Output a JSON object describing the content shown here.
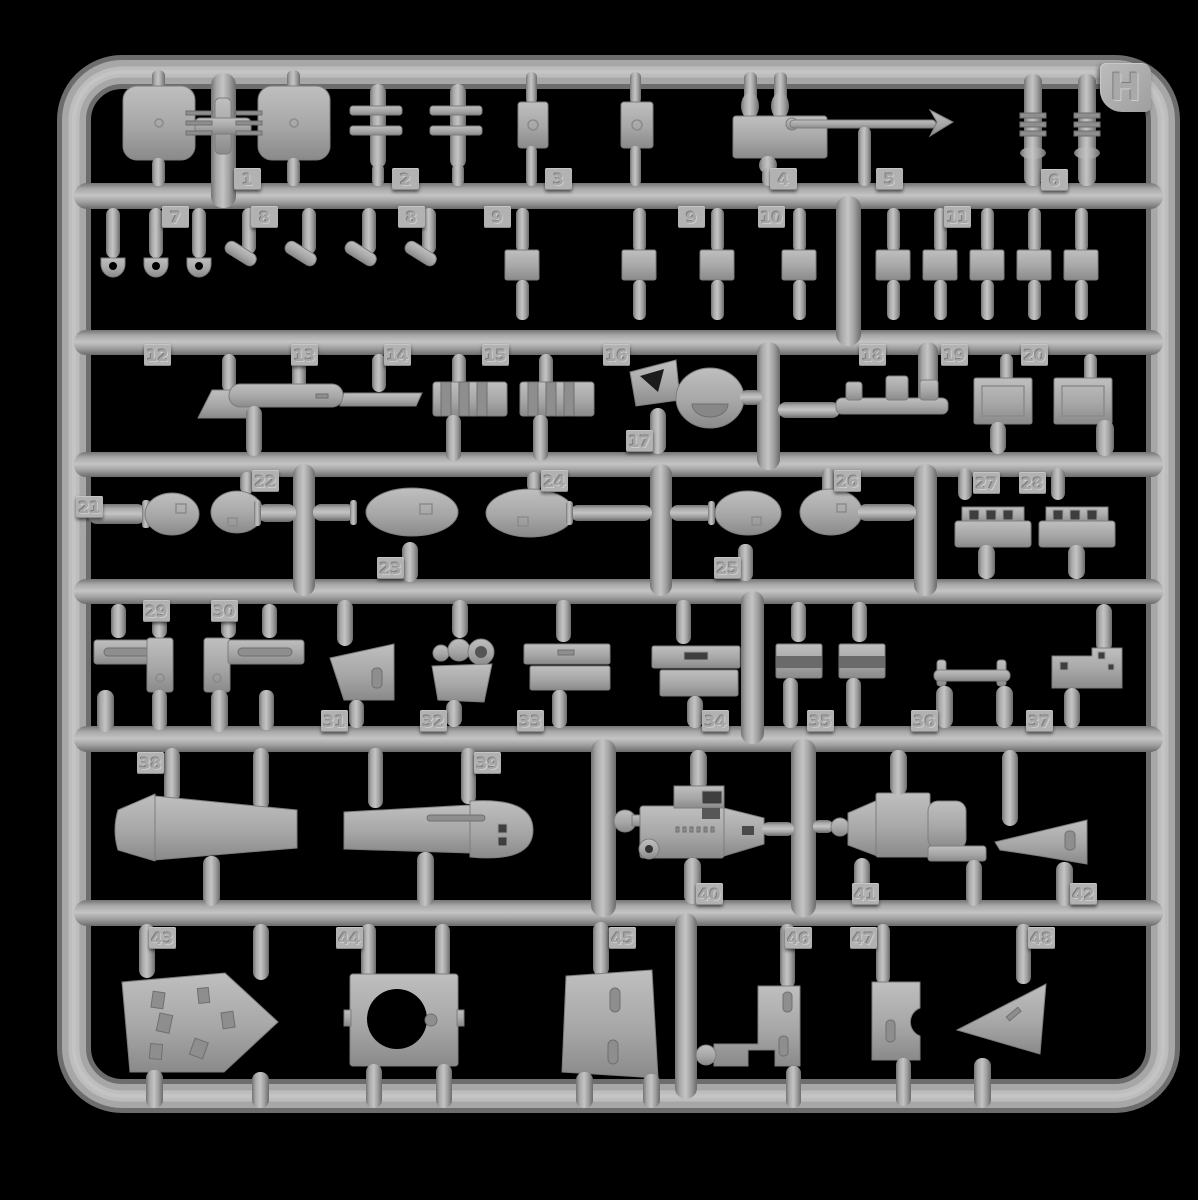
{
  "colors": {
    "background": "#000000",
    "plastic_mid": "#a9a9a9",
    "plastic_highlight": "#c4c4c4",
    "plastic_shadow": "#6e6e6e",
    "tag_plate": "#b2b2b2"
  },
  "sprue": {
    "letter": "H",
    "part_tags": [
      {
        "label": "1",
        "x": 234,
        "y": 168
      },
      {
        "label": "2",
        "x": 392,
        "y": 168
      },
      {
        "label": "3",
        "x": 545,
        "y": 168
      },
      {
        "label": "4",
        "x": 770,
        "y": 168
      },
      {
        "label": "5",
        "x": 876,
        "y": 168
      },
      {
        "label": "6",
        "x": 1041,
        "y": 169
      },
      {
        "label": "7",
        "x": 162,
        "y": 206
      },
      {
        "label": "8",
        "x": 251,
        "y": 206
      },
      {
        "label": "8",
        "x": 398,
        "y": 206
      },
      {
        "label": "9",
        "x": 484,
        "y": 206
      },
      {
        "label": "9",
        "x": 678,
        "y": 206
      },
      {
        "label": "10",
        "x": 758,
        "y": 206
      },
      {
        "label": "11",
        "x": 944,
        "y": 206
      },
      {
        "label": "12",
        "x": 144,
        "y": 344
      },
      {
        "label": "13",
        "x": 291,
        "y": 344
      },
      {
        "label": "14",
        "x": 384,
        "y": 344
      },
      {
        "label": "15",
        "x": 482,
        "y": 344
      },
      {
        "label": "16",
        "x": 603,
        "y": 344
      },
      {
        "label": "17",
        "x": 626,
        "y": 430
      },
      {
        "label": "18",
        "x": 859,
        "y": 344
      },
      {
        "label": "19",
        "x": 941,
        "y": 344
      },
      {
        "label": "20",
        "x": 1021,
        "y": 344
      },
      {
        "label": "21",
        "x": 76,
        "y": 496
      },
      {
        "label": "22",
        "x": 252,
        "y": 470
      },
      {
        "label": "23",
        "x": 377,
        "y": 557
      },
      {
        "label": "24",
        "x": 541,
        "y": 470
      },
      {
        "label": "25",
        "x": 714,
        "y": 557
      },
      {
        "label": "26",
        "x": 834,
        "y": 470
      },
      {
        "label": "27",
        "x": 973,
        "y": 472
      },
      {
        "label": "28",
        "x": 1019,
        "y": 472
      },
      {
        "label": "29",
        "x": 143,
        "y": 600
      },
      {
        "label": "30",
        "x": 211,
        "y": 600
      },
      {
        "label": "31",
        "x": 321,
        "y": 710
      },
      {
        "label": "32",
        "x": 420,
        "y": 710
      },
      {
        "label": "33",
        "x": 517,
        "y": 710
      },
      {
        "label": "34",
        "x": 702,
        "y": 710
      },
      {
        "label": "35",
        "x": 807,
        "y": 710
      },
      {
        "label": "36",
        "x": 911,
        "y": 710
      },
      {
        "label": "37",
        "x": 1026,
        "y": 710
      },
      {
        "label": "38",
        "x": 137,
        "y": 752
      },
      {
        "label": "39",
        "x": 474,
        "y": 752
      },
      {
        "label": "40",
        "x": 696,
        "y": 883
      },
      {
        "label": "41",
        "x": 852,
        "y": 883
      },
      {
        "label": "42",
        "x": 1070,
        "y": 883
      },
      {
        "label": "43",
        "x": 149,
        "y": 927
      },
      {
        "label": "44",
        "x": 336,
        "y": 927
      },
      {
        "label": "45",
        "x": 609,
        "y": 927
      },
      {
        "label": "46",
        "x": 785,
        "y": 927
      },
      {
        "label": "47",
        "x": 850,
        "y": 927
      },
      {
        "label": "48",
        "x": 1028,
        "y": 927
      }
    ]
  }
}
